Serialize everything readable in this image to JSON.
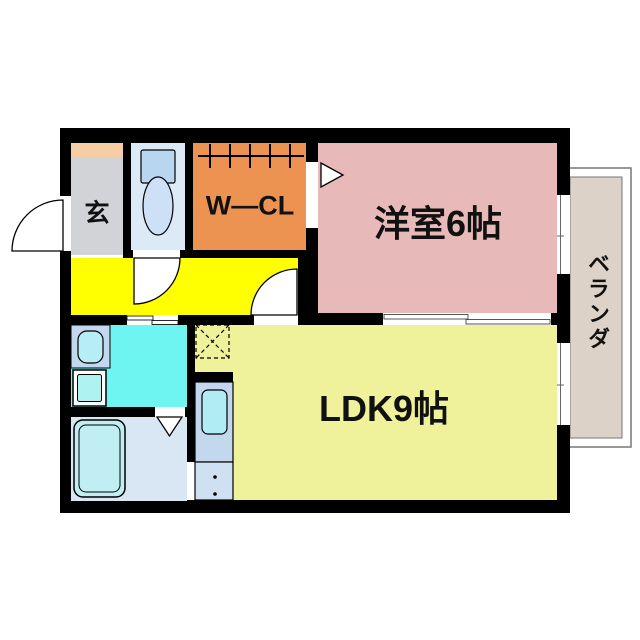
{
  "plan": {
    "type": "japanese-apartment-floor-plan",
    "labels": {
      "entrance": "玄",
      "walk_in_closet": "W—CL",
      "western_room": "洋室6帖",
      "ldk": "LDK9帖",
      "veranda": "ベランダ"
    },
    "colors": {
      "wall": "#000000",
      "entrance_cabinet": "#f6cda5",
      "entrance_floor": "#d2d3d6",
      "toilet_room": "#dceaf8",
      "toilet_tank": "#b9d6f0",
      "toilet_bowl": "#cde0f5",
      "walk_in_closet": "#ec9352",
      "hallway": "#ffff02",
      "western_room": "#e7b9b9",
      "ldk": "#eff29b",
      "washroom": "#6ff5f1",
      "vanity": "#c3d7ee",
      "vanity_basin": "#b7edf5",
      "washing_machine": "#aef2f2",
      "bathroom": "#d9e7f5",
      "bathtub": "#c0eef3",
      "kitchen_counter": "#c3d8ec",
      "kitchen_sink": "#b0ecf4",
      "kitchen_cabinet": "#cfe0f2",
      "veranda_floor": "#dcd2c8",
      "veranda_frame": "#777777",
      "window_glass": "#ffffff"
    },
    "symbols": {
      "entrance_door": "quarter-circle outward swing door",
      "toilet": "tank and bowl fixture",
      "closet_rod": "hanger pipe with tick marks",
      "entry_arrow": "white triangle pointing into room",
      "sliding_door": "offset double white panels",
      "vanity": "basin oval inside square",
      "washing_machine": "double-bordered square",
      "bathtub": "double-bordered rounded rectangle",
      "folding_bath_door": "downward V triangle",
      "kitchen_sink": "rounded rectangle in counter",
      "refrigerator_space": "dashed square with X",
      "window": "white band in wall with glazing line"
    }
  }
}
